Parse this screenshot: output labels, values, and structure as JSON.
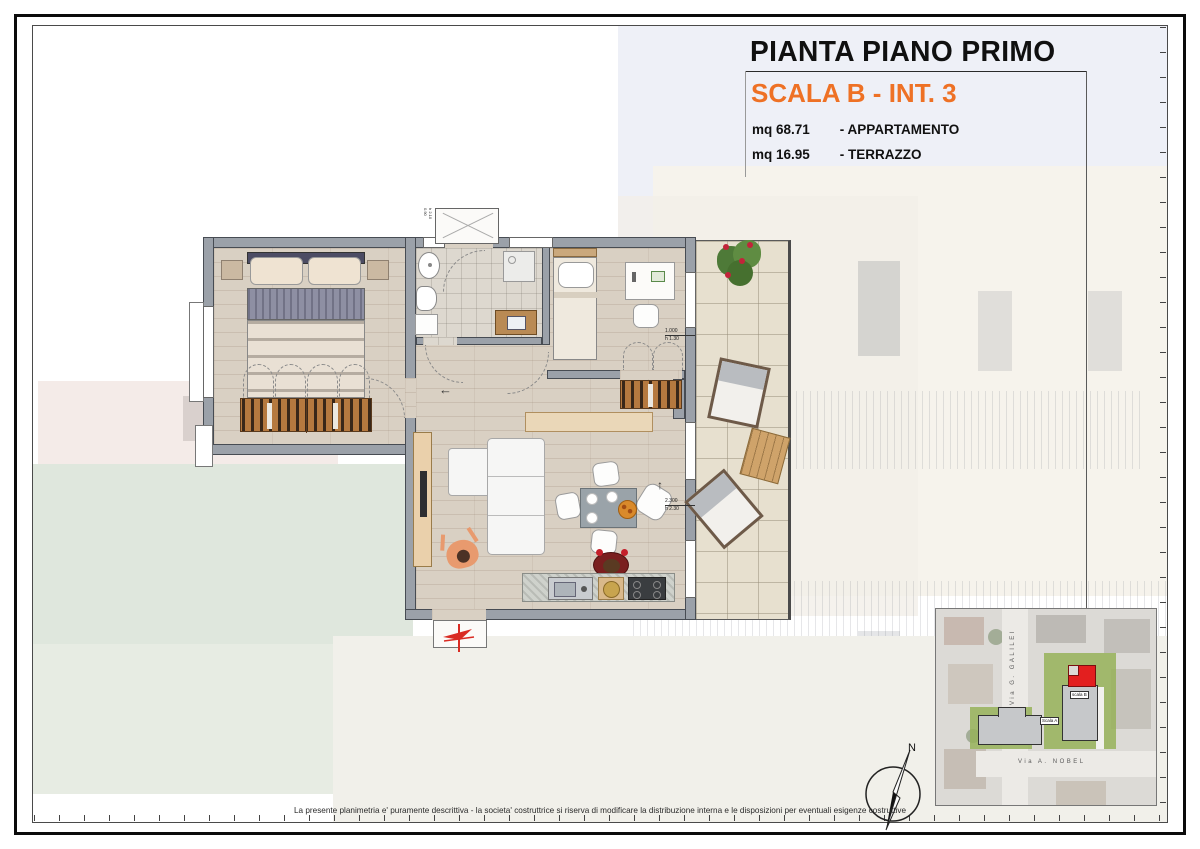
{
  "colors": {
    "accent": "#ee7125",
    "wall": "#9ba1a9",
    "wall_outline": "#474c53",
    "wood": "#d9d0c3",
    "tile": "#e7e0cf",
    "red_marker": "#e31f1f"
  },
  "title_block": {
    "title": "PIANTA PIANO PRIMO",
    "subtitle": "SCALA B - INT. 3",
    "areas": [
      {
        "value": "mq 68.71",
        "label": "- APPARTAMENTO"
      },
      {
        "value": "mq 16.95",
        "label": "- TERRAZZO"
      }
    ]
  },
  "floorplan": {
    "window_dims": [
      {
        "size": "1.000",
        "height": "h 1.30"
      },
      {
        "size": "2.300",
        "height": "h 2.30"
      }
    ],
    "entrance_labels": [
      {
        "size": "0.90",
        "height": "h 2.10"
      }
    ],
    "arrows": {
      "left": "←",
      "up": "↑"
    }
  },
  "site_map": {
    "street_vertical": "Via  G. GALILEI",
    "street_horizontal": "Via   A. NOBEL",
    "building_labels": [
      "scala B",
      "Scala A"
    ]
  },
  "compass": {
    "label": "N"
  },
  "footer": {
    "disclaimer": "La presente planimetria e' puramente descrittiva - la societa' costruttrice si riserva di modificare la distribuzione interna e le disposizioni per eventuali esigenze costruttive"
  }
}
